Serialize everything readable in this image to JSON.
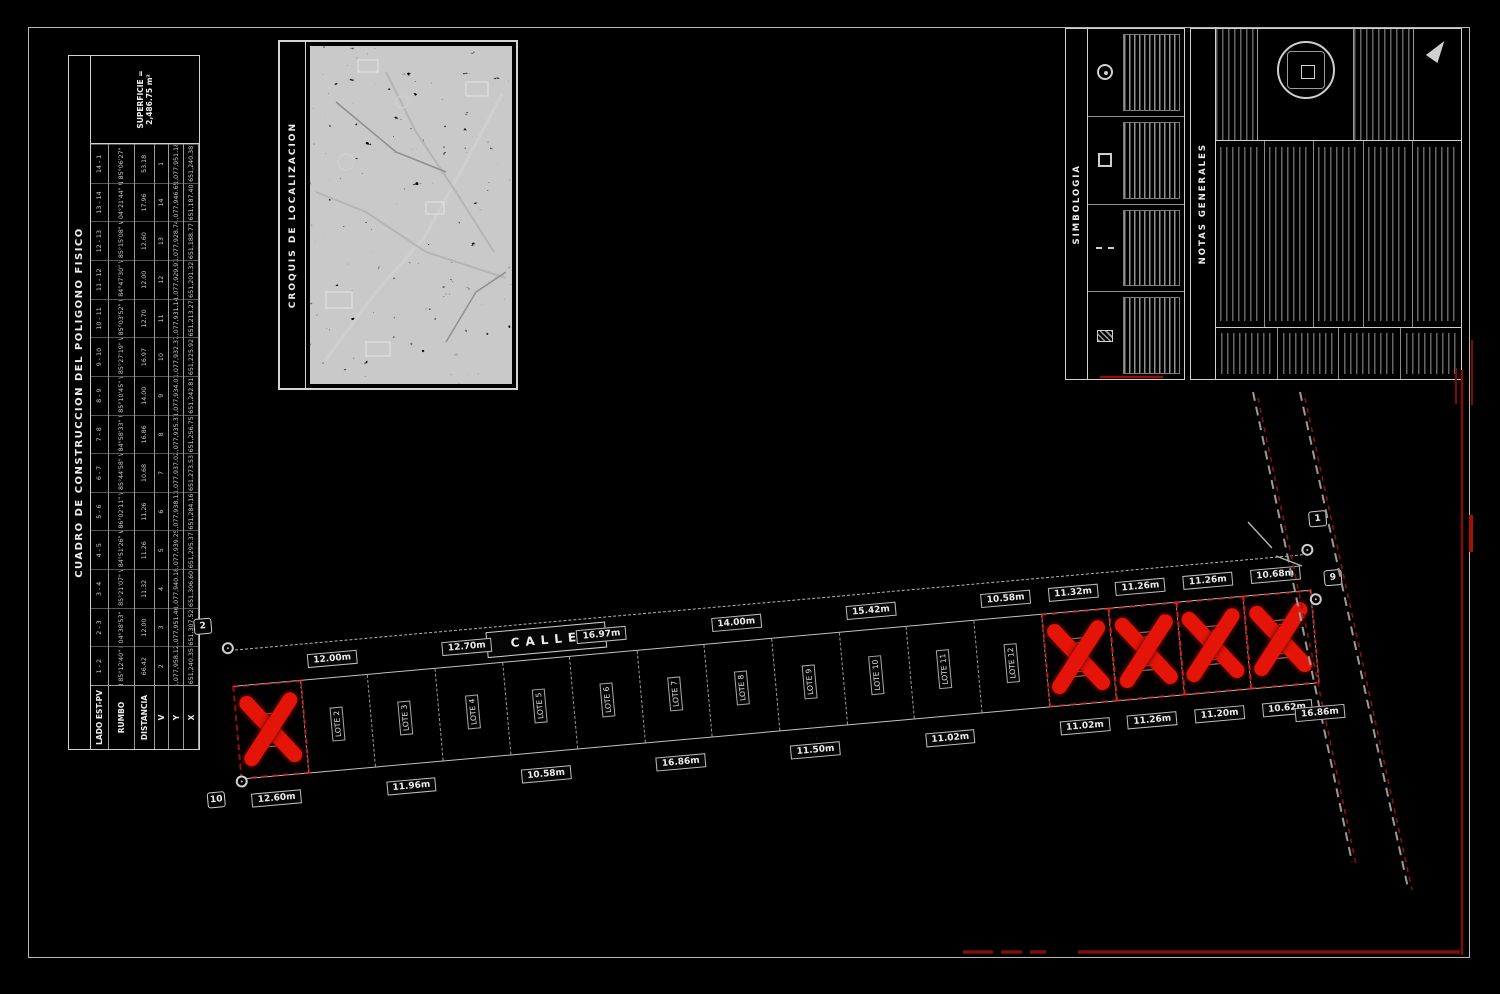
{
  "sheet": {
    "bg": "#000000",
    "frame_color": "#b9b9b9",
    "line_color": "#cfcfcf",
    "red": "#e51408",
    "dark_red": "#7e0e08"
  },
  "construction_table": {
    "title": "CUADRO DE CONSTRUCCION DEL POLIGONO FISICO",
    "footer": "SUPERFICIE = 2,486.75 m²",
    "col_headers": {
      "lado": "LADO EST-PV",
      "rumbo": "RUMBO",
      "distancia": "DISTANCIA",
      "v": "V",
      "y": "Y",
      "x": "X"
    },
    "rows": [
      {
        "lado": "1 - 2",
        "rumbo": "N 85°12'40\" E",
        "dist": "66.42",
        "v": "2",
        "y": "1,077,958.12",
        "x": "651,240.35"
      },
      {
        "lado": "2 - 3",
        "rumbo": "S 04°38'53\" E",
        "dist": "12.00",
        "v": "3",
        "y": "1,077,951.46",
        "x": "651,307.52"
      },
      {
        "lado": "3 - 4",
        "rumbo": "S 85°21'07\" W",
        "dist": "11.32",
        "v": "4",
        "y": "1,077,940.18",
        "x": "651,306.60"
      },
      {
        "lado": "4 - 5",
        "rumbo": "S 84°51'26\" W",
        "dist": "11.26",
        "v": "5",
        "y": "1,077,939.25",
        "x": "651,295.37"
      },
      {
        "lado": "5 - 6",
        "rumbo": "S 86°02'11\" W",
        "dist": "11.26",
        "v": "6",
        "y": "1,077,938.11",
        "x": "651,284.16"
      },
      {
        "lado": "6 - 7",
        "rumbo": "S 85°44'58\" W",
        "dist": "10.68",
        "v": "7",
        "y": "1,077,937.02",
        "x": "651,273.53"
      },
      {
        "lado": "7 - 8",
        "rumbo": "S 84°58'33\" W",
        "dist": "16.86",
        "v": "8",
        "y": "1,077,935.37",
        "x": "651,256.75"
      },
      {
        "lado": "8 - 9",
        "rumbo": "S 85°10'45\" W",
        "dist": "14.00",
        "v": "9",
        "y": "1,077,934.01",
        "x": "651,242.81"
      },
      {
        "lado": "9 - 10",
        "rumbo": "S 85°27'19\" W",
        "dist": "16.97",
        "v": "10",
        "y": "1,077,932.37",
        "x": "651,225.92"
      },
      {
        "lado": "10 - 11",
        "rumbo": "S 85°03'52\" W",
        "dist": "12.70",
        "v": "11",
        "y": "1,077,931.14",
        "x": "651,213.27"
      },
      {
        "lado": "11 - 12",
        "rumbo": "S 84°47'30\" W",
        "dist": "12.00",
        "v": "12",
        "y": "1,077,929.97",
        "x": "651,201.32"
      },
      {
        "lado": "12 - 13",
        "rumbo": "S 85°15'08\" W",
        "dist": "12.60",
        "v": "13",
        "y": "1,077,928.74",
        "x": "651,188.77"
      },
      {
        "lado": "13 - 14",
        "rumbo": "N 04°21'44\" W",
        "dist": "17.96",
        "v": "14",
        "y": "1,077,946.65",
        "x": "651,187.40"
      },
      {
        "lado": "14 - 1",
        "rumbo": "N 85°06'27\" E",
        "dist": "53.18",
        "v": "1",
        "y": "1,077,951.18",
        "x": "651,240.38"
      }
    ]
  },
  "croquis": {
    "title": "CROQUIS DE LOCALIZACION"
  },
  "simbologia": {
    "title": "SIMBOLOGIA",
    "items": [
      {
        "icon": "vertex-circle-icon"
      },
      {
        "icon": "boundary-square-icon"
      },
      {
        "icon": "limit-dash-line-icon"
      },
      {
        "icon": "construction-hatch-icon"
      }
    ]
  },
  "notas": {
    "title": "NOTAS GENERALES"
  },
  "drawing": {
    "street_label": "CALLE",
    "vertices": {
      "left_top": "2",
      "left_bottom": "10",
      "right_top": "1",
      "right_bottom": "9"
    },
    "end_dim": "16.86m",
    "lots": [
      {
        "label": "LOTE 1",
        "dim_top": "",
        "dim_bottom": "12.60m",
        "crossed": true
      },
      {
        "label": "LOTE 2",
        "dim_top": "12.00m",
        "dim_bottom": "",
        "crossed": false
      },
      {
        "label": "LOTE 3",
        "dim_top": "",
        "dim_bottom": "11.96m",
        "crossed": false
      },
      {
        "label": "LOTE 4",
        "dim_top": "12.70m",
        "dim_bottom": "",
        "crossed": false
      },
      {
        "label": "LOTE 5",
        "dim_top": "",
        "dim_bottom": "10.58m",
        "crossed": false
      },
      {
        "label": "LOTE 6",
        "dim_top": "16.97m",
        "dim_bottom": "",
        "crossed": false
      },
      {
        "label": "LOTE 7",
        "dim_top": "",
        "dim_bottom": "16.86m",
        "crossed": false
      },
      {
        "label": "LOTE 8",
        "dim_top": "14.00m",
        "dim_bottom": "",
        "crossed": false
      },
      {
        "label": "LOTE 9",
        "dim_top": "",
        "dim_bottom": "11.50m",
        "crossed": false
      },
      {
        "label": "LOTE 10",
        "dim_top": "15.42m",
        "dim_bottom": "",
        "crossed": false
      },
      {
        "label": "LOTE 11",
        "dim_top": "",
        "dim_bottom": "11.02m",
        "crossed": false
      },
      {
        "label": "LOTE 12",
        "dim_top": "10.58m",
        "dim_bottom": "",
        "crossed": false
      },
      {
        "label": "LOTE 13",
        "dim_top": "11.32m",
        "dim_bottom": "11.02m",
        "crossed": true
      },
      {
        "label": "LOTE 14",
        "dim_top": "11.26m",
        "dim_bottom": "11.26m",
        "crossed": true
      },
      {
        "label": "LOTE 15",
        "dim_top": "11.26m",
        "dim_bottom": "11.20m",
        "crossed": true
      },
      {
        "label": "LOTE 16",
        "dim_top": "10.68m",
        "dim_bottom": "10.62m",
        "crossed": true
      }
    ]
  }
}
